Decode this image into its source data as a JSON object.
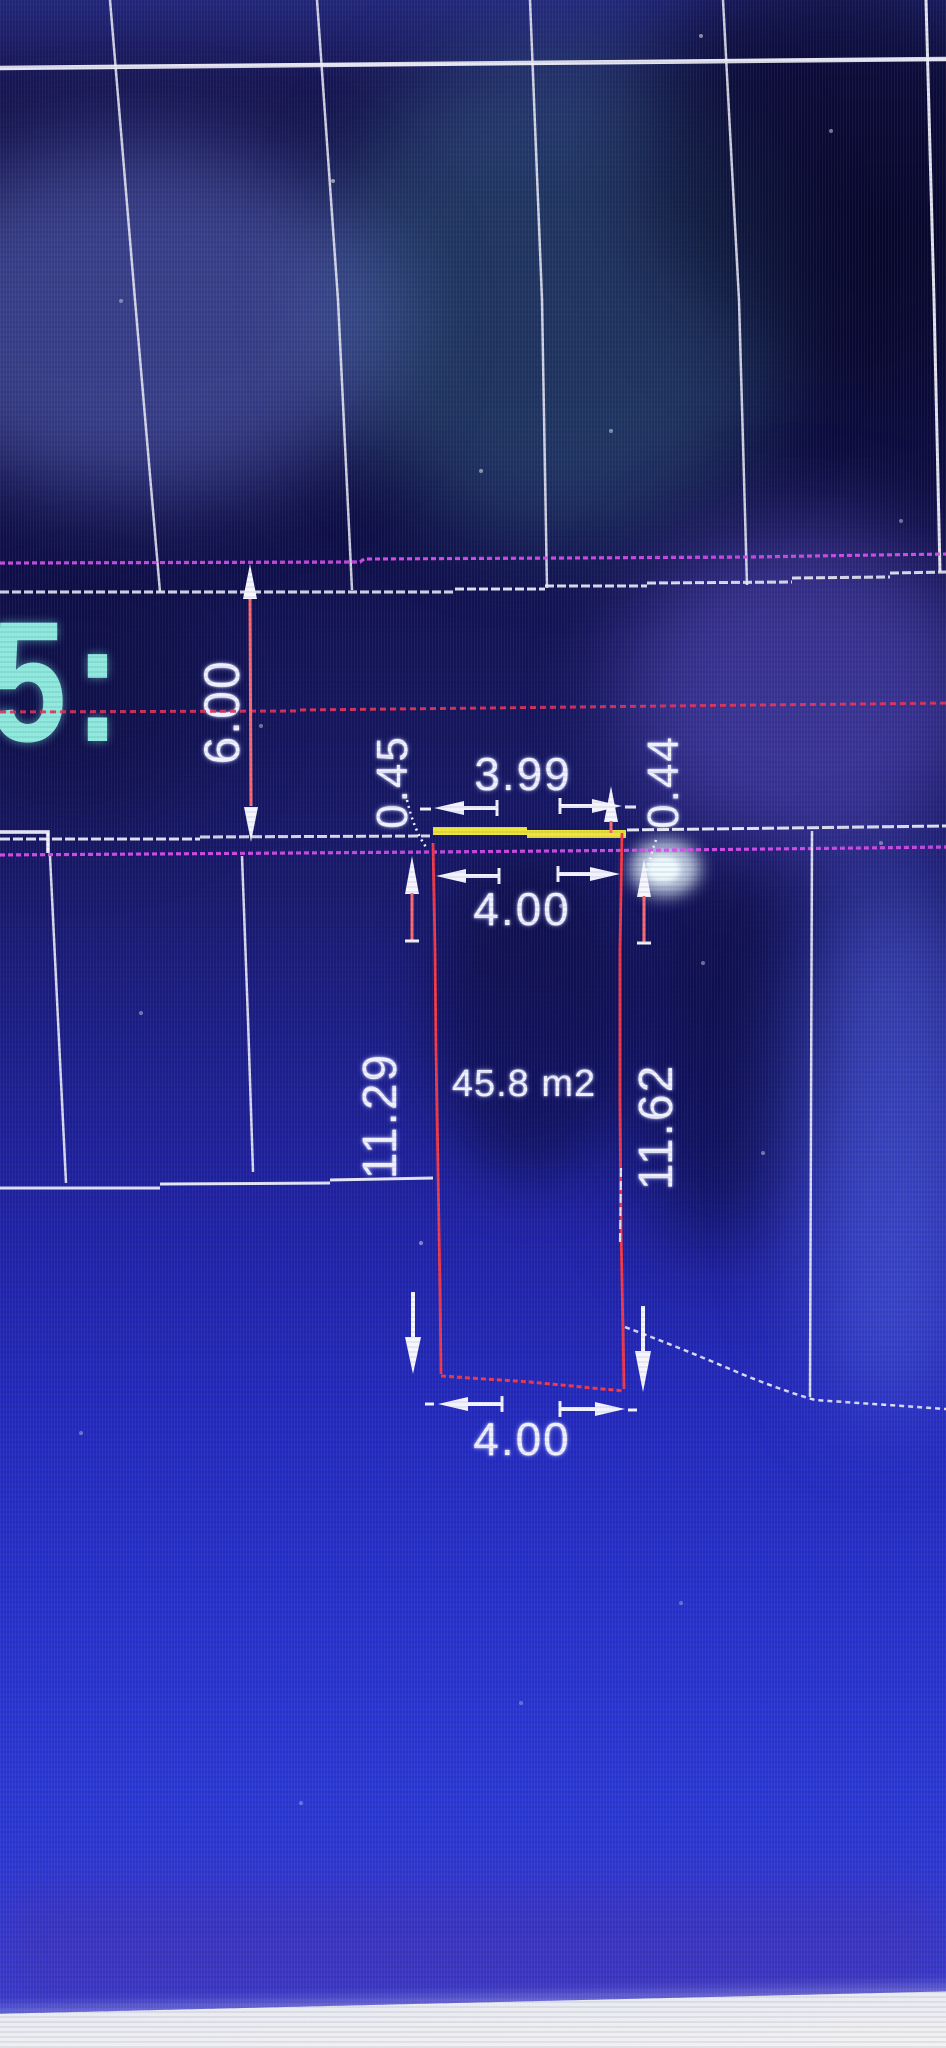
{
  "screen": {
    "plot_label": "5:",
    "area_label": "45.8 m2",
    "dims": {
      "road_width": "6.00",
      "offset_left": "0.45",
      "top_outer": "3.99",
      "offset_right": "0.44",
      "top_inner": "4.00",
      "side_left": "11.29",
      "side_right": "11.62",
      "bottom": "4.00"
    },
    "colors": {
      "background_blue": "#1e22a0",
      "line_white": "#f0f0fa",
      "road_magenta": "#d44dea",
      "offset_line_red": "#e6335a",
      "parcel_red": "#f23848",
      "frontage_yellow": "#ece43a",
      "plot_label_teal": "#8ee9dd",
      "dimension_text": "#f0f1ff"
    }
  }
}
